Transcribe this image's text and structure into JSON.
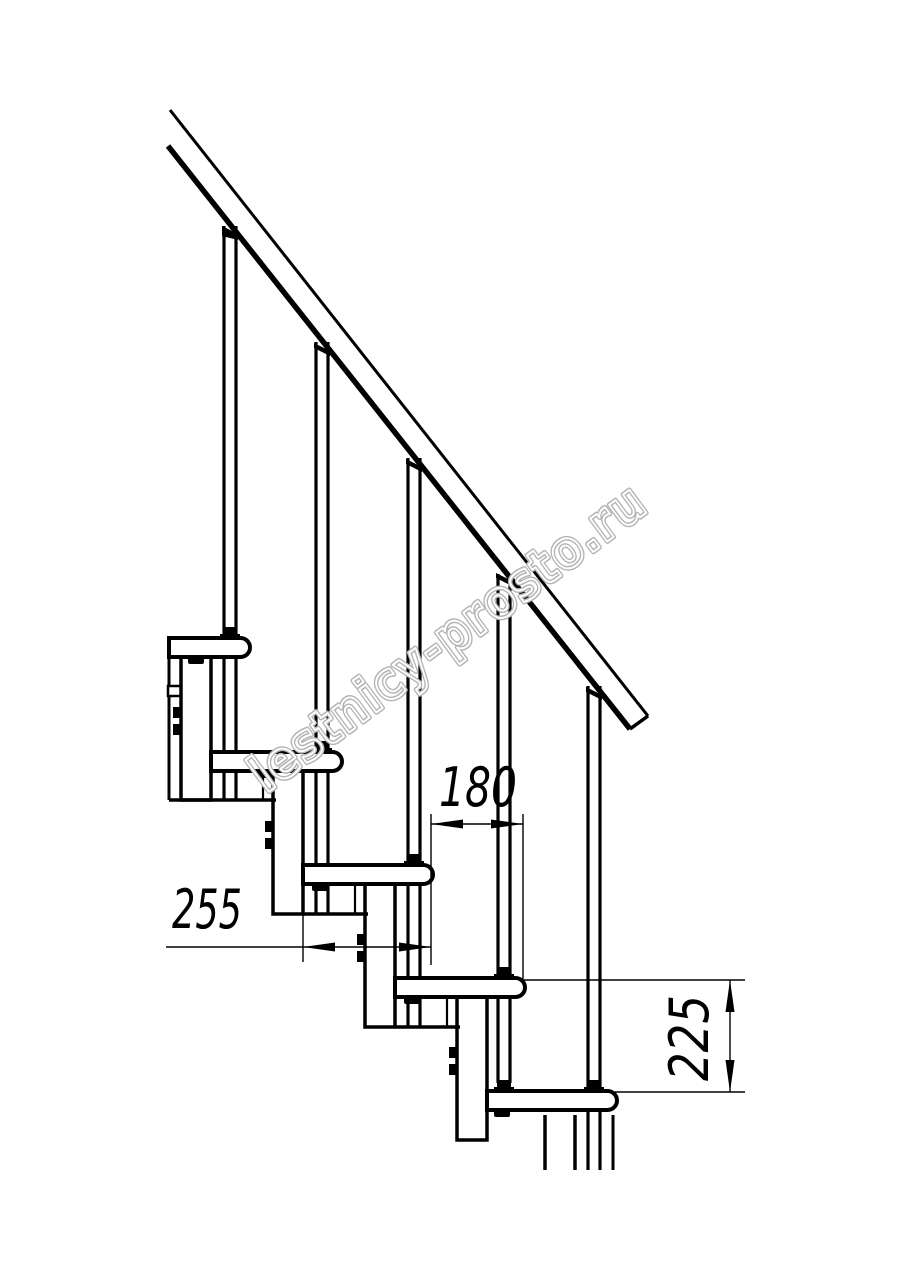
{
  "drawing": {
    "title": "modular-staircase-side-view",
    "dimensions": {
      "tread_depth": "255",
      "run": "180",
      "rise": "225"
    },
    "watermark_text": "lestnicy-prosto.ru",
    "colors": {
      "line": "#000000",
      "watermark": "#b4b4b4",
      "background": "#ffffff"
    }
  }
}
